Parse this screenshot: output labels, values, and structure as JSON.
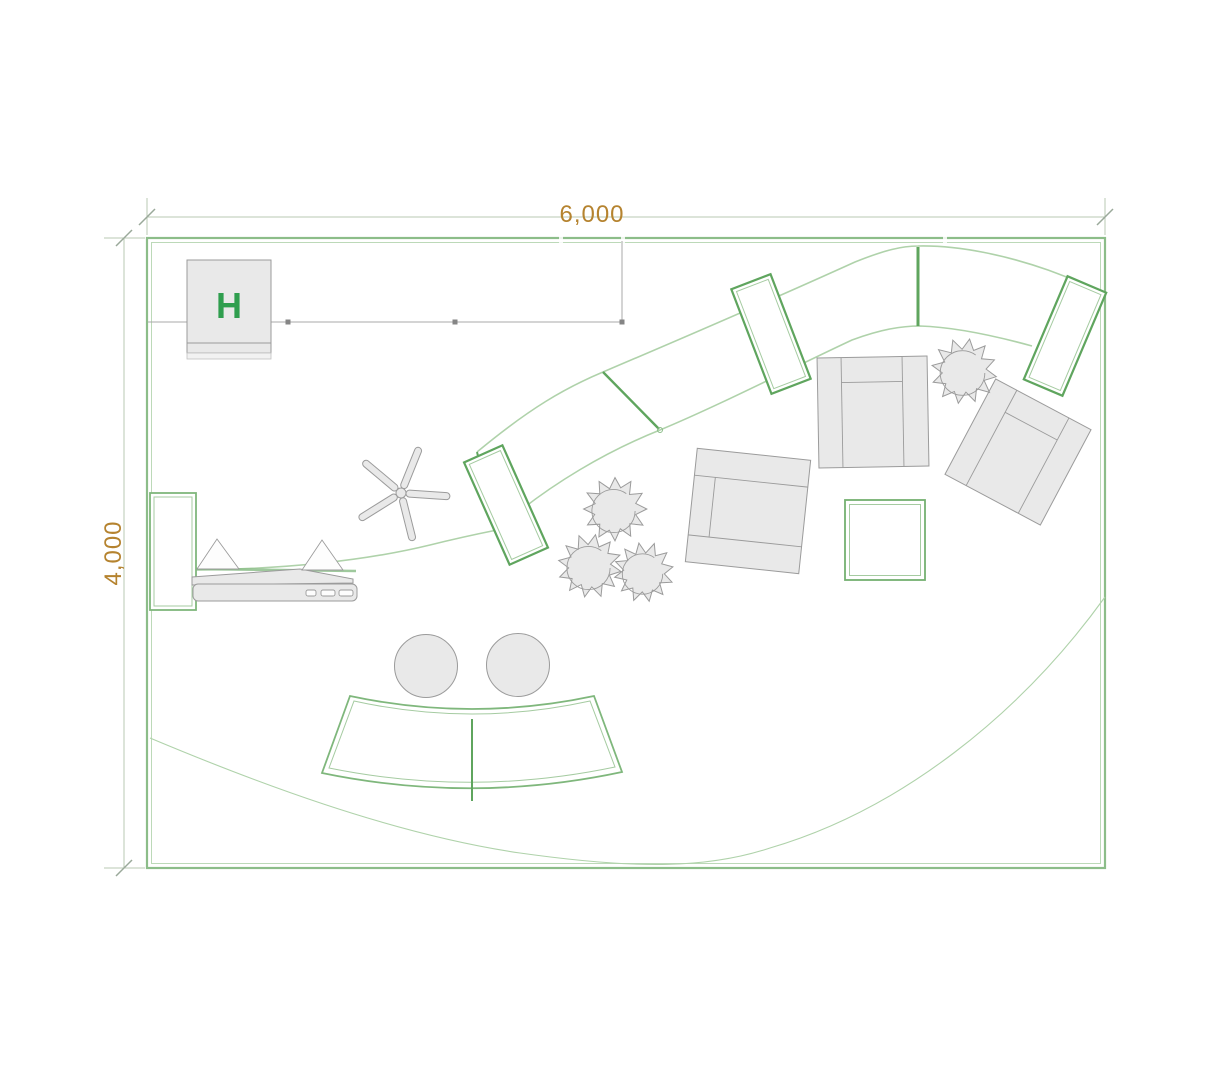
{
  "plan": {
    "dimension_width_label": "6,000",
    "dimension_height_label": "4,000",
    "hall_marker_label": "H"
  },
  "colors": {
    "background": "#ffffff",
    "wall_green": "#8cbd89",
    "wall_green_light": "#bcd9b8",
    "panel_green": "#5fa55e",
    "panel_green_light": "#a5cba1",
    "curve_green": "#afd2aa",
    "desk_green": "#7fb77c",
    "dimension_line": "#b8c8b3",
    "dimension_tick": "#9aa99a",
    "dimension_text": "#b5832f",
    "hall_marker_text": "#2f9e4e",
    "furniture_fill": "#e9e9e9",
    "furniture_stroke": "#9b9b9b",
    "track_grey": "#a8a8a8"
  },
  "icons": {
    "plant-icon": "jagged-circle shrub symbol",
    "office-chair-base-icon": "five-arm star chair base",
    "brochure-stand-icon": "triangle easel symbol",
    "laptop-icon": "flat laptop on counter",
    "armchair-icon": "square armchair with back and armrests",
    "sofa-icon": "square sofa with back, arm and front band",
    "stool-icon": "round stool circle",
    "coffee-table-icon": "square double-line table outline",
    "curved-counter-icon": "curved two-segment reception counter",
    "curved-wall-icon": "s-shaped curved wall band with dividers"
  }
}
